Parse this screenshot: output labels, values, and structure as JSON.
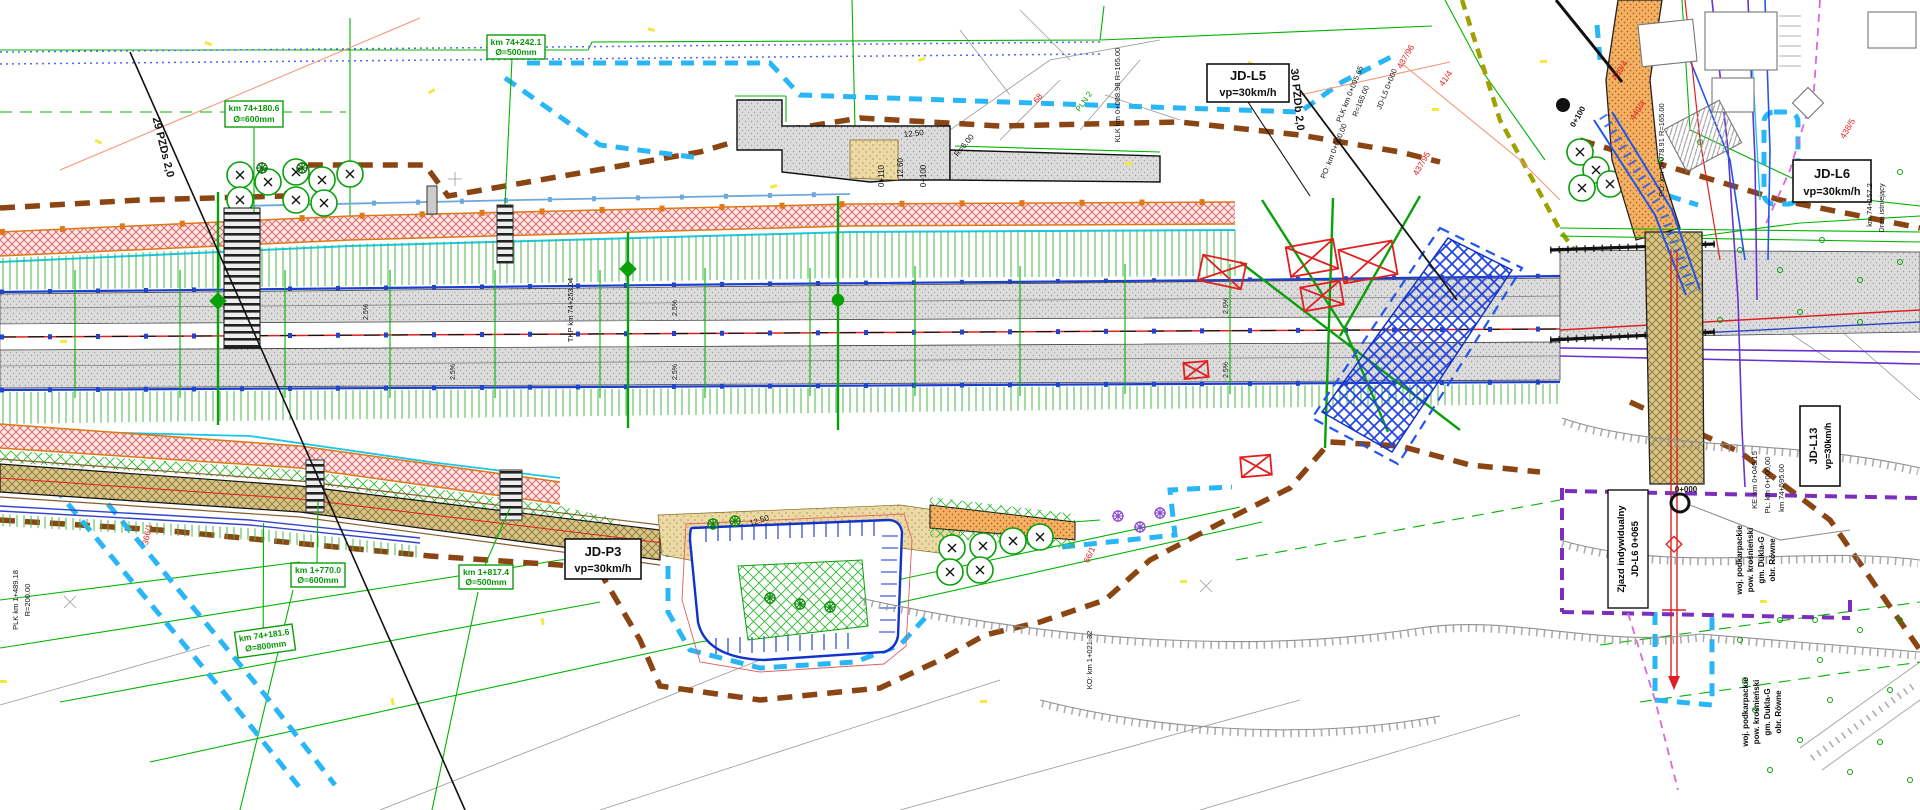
{
  "colors": {
    "boundary_brown": "#8B4513",
    "boundary_cyan": "#29B6F6",
    "boundary_purple": "#7B2FBE",
    "boundary_olive": "#A0A000",
    "parcel_green": "#00B400",
    "edge_blue": "#1A3FD0",
    "axis_red": "#E02020",
    "utility_violet": "#6633CC",
    "embankment_pink": "#D96A6A",
    "road_gray": "#DCDCDC",
    "road_tan": "#D6C489",
    "road_orange": "#F2B366",
    "hatch_blue": "#2244DD"
  },
  "route_labels": {
    "jd_l5": {
      "name": "JD-L5",
      "speed": "vp=30km/h"
    },
    "jd_l6": {
      "name": "JD-L6",
      "speed": "vp=30km/h"
    },
    "jd_p3": {
      "name": "JD-P3",
      "speed": "vp=30km/h"
    },
    "jd_l13": {
      "name": "JD-L13",
      "speed": "vp=30km/h"
    },
    "zjazd": {
      "line1": "Zjazd indywidualny",
      "line2": "JD-L6 0+065"
    }
  },
  "pipe_labels": [
    {
      "km": "km 74+180.6",
      "dia": "Ø=600mm"
    },
    {
      "km": "km 74+242.1",
      "dia": "Ø=500mm"
    },
    {
      "km": "km 1+770.0",
      "dia": "Ø=600mm"
    },
    {
      "km": "km 1+817.4",
      "dia": "Ø=500mm"
    },
    {
      "km": "km 74+181.6",
      "dia": "Ø=800mm"
    }
  ],
  "passage_labels": [
    "29 PZDs 2,0",
    "30 PZDb 2,0"
  ],
  "notes": [
    "TKP km 74+253.04",
    "KLK km 0+088.98 R=165.00",
    "PLK km 0+095.65",
    "R=165.00",
    "PO: km 0+000,00",
    "JD-L5 0+000",
    "PO: km 0+078.91 R=165.00",
    "0+100",
    "0+000",
    "KO: km 1+021.32",
    "PLK km 1+489.18",
    "R=200.00",
    "KE: km 0+049.15",
    "PŁ: km 0+000,00",
    "km 74+595.00",
    "km 74+157.2",
    "Dren istniejący"
  ],
  "admin_block": [
    "woj. podkarpackie",
    "pow. krośnieński",
    "gm. Dukla-G",
    "obr. Równe"
  ],
  "parcel_numbers": [
    "437/96",
    "438/5",
    "439/4",
    "440/4",
    "41/4",
    "366/1",
    "66/1",
    "68",
    "437/95"
  ],
  "survey_labels": [
    "PLN 2"
  ],
  "dimensions": [
    "12.50",
    "12.60",
    "R=6.00",
    "0+100",
    "0+110",
    "12.50"
  ],
  "slope_label": "2.5%"
}
